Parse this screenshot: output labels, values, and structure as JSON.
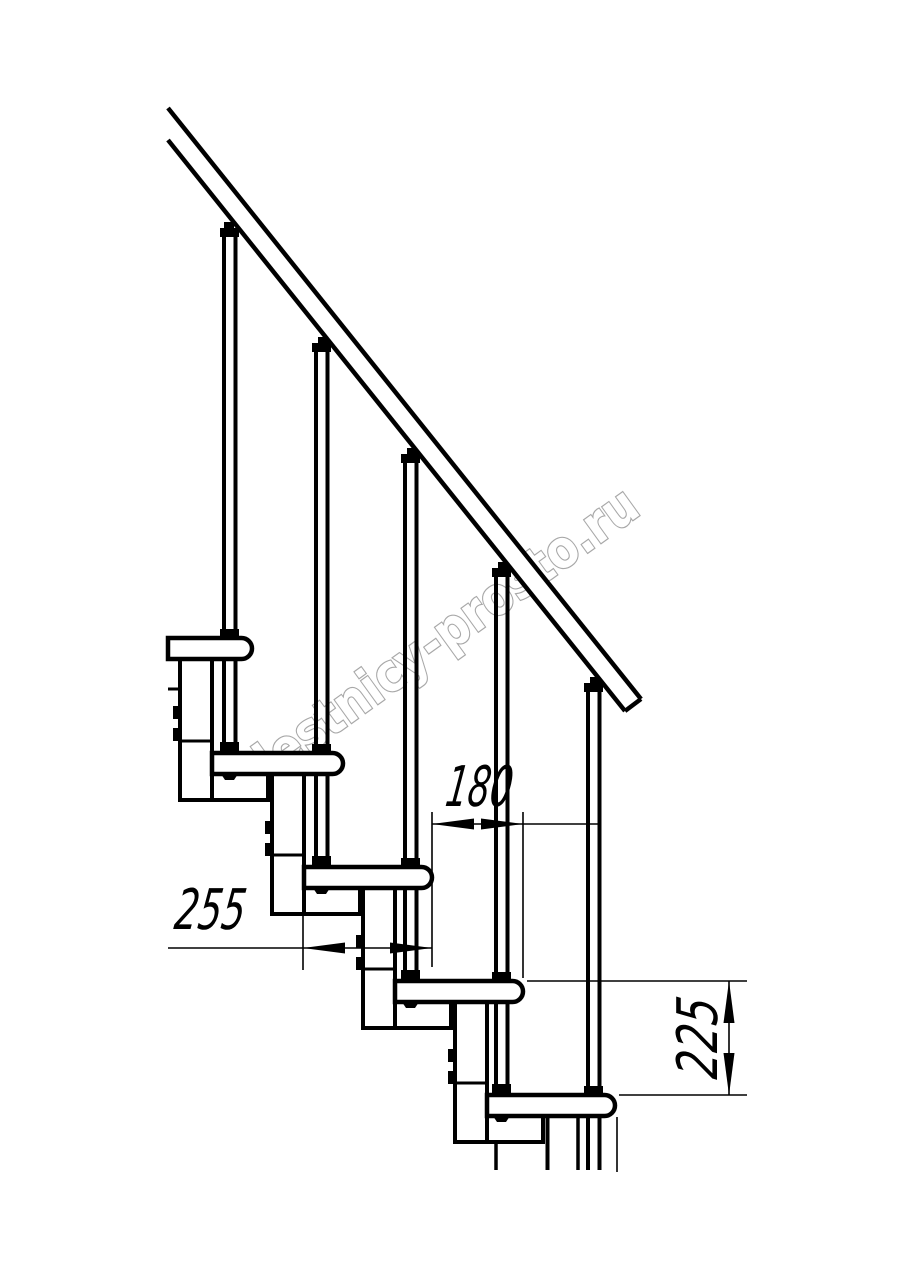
{
  "drawing": {
    "background": "#ffffff",
    "line_color": "#000000",
    "watermark": {
      "text": "lestnicy-prosto.ru",
      "color": "#a8a8a8"
    },
    "dimensions": {
      "going": {
        "value": "180"
      },
      "tread_depth": {
        "value": "255"
      },
      "rise": {
        "value": "225"
      }
    }
  }
}
